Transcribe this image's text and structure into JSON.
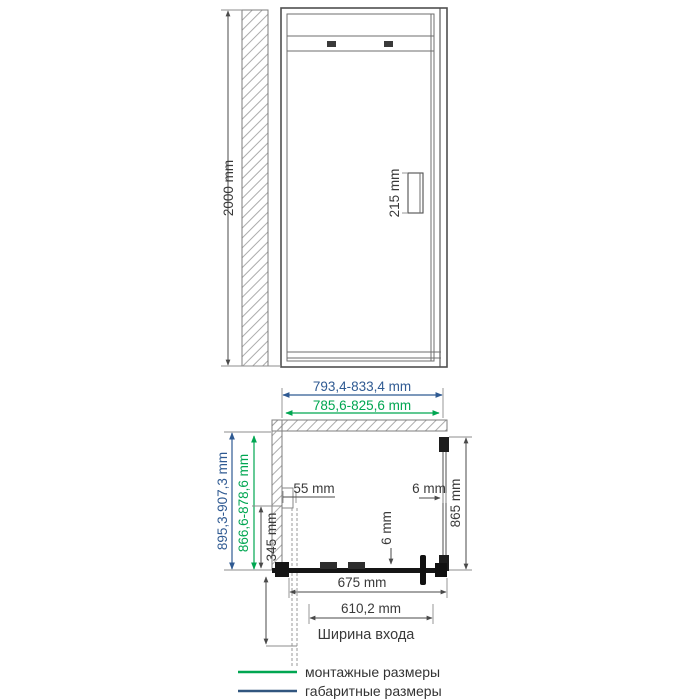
{
  "drawing": {
    "front_view": {
      "height": "2000 mm",
      "handle_height": "215 mm"
    },
    "top_view": {
      "overall_width": "793,4-833,4 mm",
      "mounting_width": "785,6-825,6 mm",
      "overall_depth": "895,3-907,3 mm",
      "mounting_depth": "866,6-878,6 mm",
      "wall_profile_width": "55 mm",
      "side_offset": "345 mm",
      "side_glass_length": "865 mm",
      "side_glass_thickness": "6 mm",
      "door_glass_thickness": "6 mm",
      "door_front_width": "675 mm",
      "entrance_width": "610,2 mm",
      "entrance_caption": "Ширина входа"
    },
    "legend": {
      "items": [
        {
          "label": "монтажные размеры",
          "color": "#00a651"
        },
        {
          "label": "габаритные размеры",
          "color": "#31567f"
        }
      ]
    },
    "colors": {
      "mounting_green": "#00a651",
      "overall_blue": "#2f5a92",
      "line_gray": "#4a4a4a"
    }
  }
}
